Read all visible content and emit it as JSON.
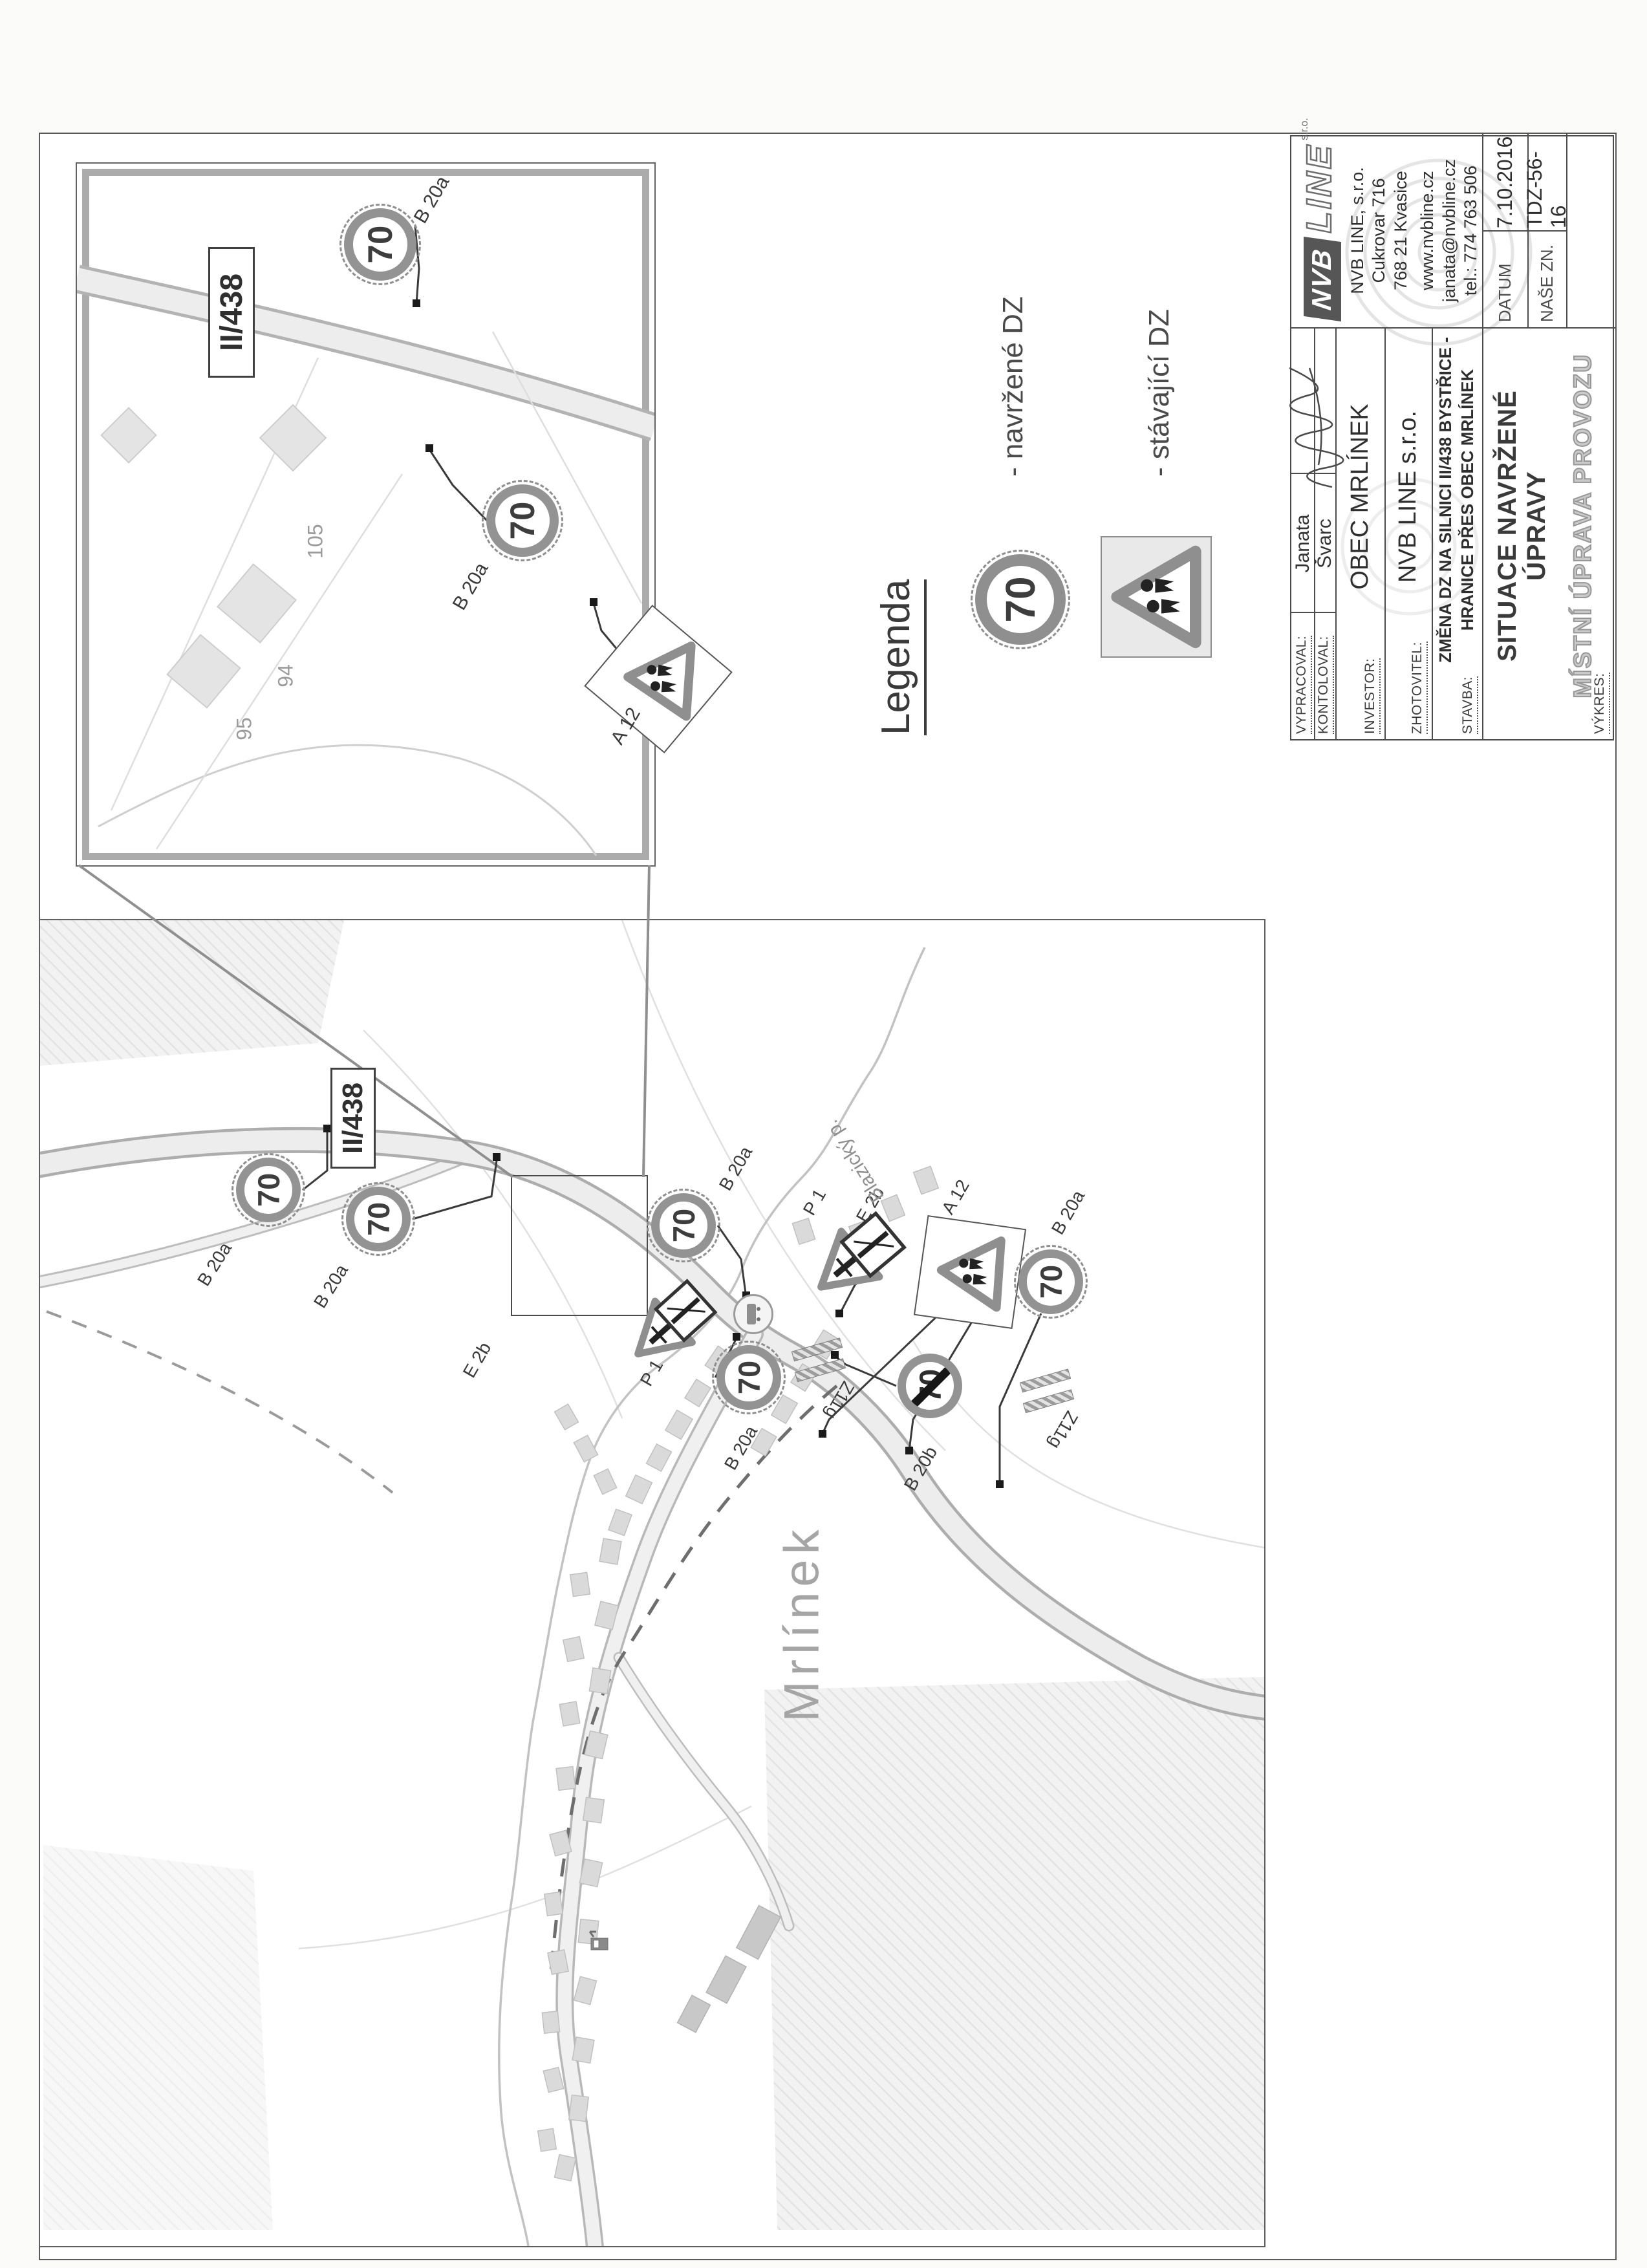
{
  "symbols": {
    "speed": "70"
  },
  "legend": {
    "title": "Legenda",
    "proposed_label": "- navržené DZ",
    "existing_label": "- stávající DZ"
  },
  "inset": {
    "road_box": "II/438",
    "b20a_top": "B 20a",
    "b20a_mid": "B 20a",
    "a12": "A 12",
    "parcels": [
      "105",
      "94",
      "95"
    ]
  },
  "map": {
    "road_box": "II/438",
    "town": "Mrlínek",
    "stream": "Blazický p.",
    "b20a_w1": "B 20a",
    "b20a_w2": "B 20a",
    "b20a_cross": "B 20a",
    "b20a_south": "B 20a",
    "b20a_east": "B 20a",
    "p1_west": "P 1",
    "p1_north": "P 1",
    "e2b_west": "E 2b",
    "e2b_north": "E 2b",
    "a12": "A 12",
    "b20b": "B 20b",
    "z11g_1": "Z11g",
    "z11g_2": "Z11g"
  },
  "title_block": {
    "vypracoval_label": "VYPRACOVAL:",
    "vypracoval_value": "Janata",
    "kontoloval_label": "KONTOLOVAL:",
    "kontoloval_value": "Švarc",
    "investor_label": "INVESTOR:",
    "investor_value": "OBEC MRLÍNEK",
    "zhotovitel_label": "ZHOTOVITEL:",
    "zhotovitel_value": "NVB LINE s.r.o.",
    "stavba_label": "STAVBA:",
    "stavba_value_line1": "ZMĚNA DZ NA SILNICI II/438 BYSTŘICE -",
    "stavba_value_line2": "HRANICE PŘES OBEC MRLÍNEK",
    "vykres_label": "VÝKRES:",
    "vykres_value": "SITUACE NAVRŽENÉ ÚPRAVY",
    "vykres_subvalue": "MÍSTNÍ ÚPRAVA PROVOZU",
    "datum_label": "DATUM",
    "datum_value": "7.10.2016",
    "zn_label": "NAŠE ZN.",
    "zn_value": "TDZ-56-16",
    "company": {
      "logo_nvb": "NVB",
      "logo_line": "LINE",
      "logo_sro": "s.r.o.",
      "name": "NVB LINE, s.r.o.",
      "address": "Cukrovar 716",
      "city": "768 21 Kvasice",
      "web": "www.nvbline.cz",
      "email": "janata@nvbline.cz",
      "phone": "tel.: 774 763 506"
    }
  }
}
